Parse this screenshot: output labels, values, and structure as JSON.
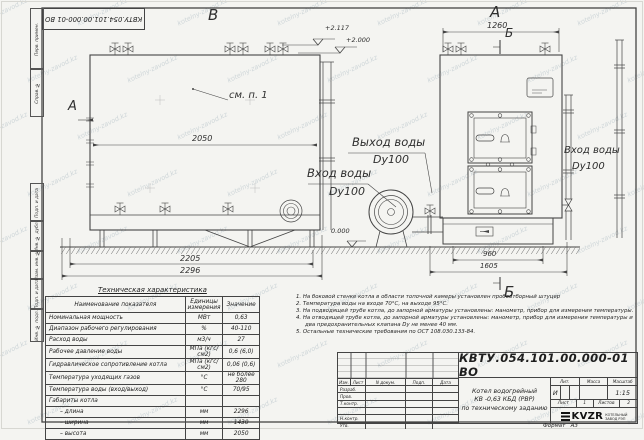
{
  "watermark": {
    "text": "kotelny-zavod.kz"
  },
  "border": {
    "top_left_designation": "КВТУ.054.101.00.000-01 ВО",
    "side_labels": [
      "Перв. примен.",
      "Справ. №",
      "Подп. и дата",
      "Инв. № дубл.",
      "Взам. инв. №",
      "Подп. и дата",
      "Инв. № подл."
    ]
  },
  "views": {
    "view_b_label": "В",
    "view_a_label": "А",
    "section_b_top": "Б",
    "section_b_bottom": "Б",
    "view_arrow_a": "А",
    "see_note": "см. п. 1",
    "elevations": {
      "top1": "+2.117",
      "top2": "+2.000",
      "zero": "0.000"
    },
    "labels": {
      "outlet": "Выход воды",
      "outlet_dn": "Dy100",
      "inlet_mid": "Вход воды",
      "inlet_mid_dn": "Dy100",
      "inlet_right": "Вход воды",
      "inlet_right_dn": "Dy100"
    },
    "dims": {
      "d2050": "2050",
      "d2205": "2205",
      "d2296": "2296",
      "d1260": "1260",
      "d960": "960",
      "d1605": "1605"
    }
  },
  "tech_table": {
    "title": "Техническая характеристика",
    "headers": [
      "Наименование показателя",
      "Единицы измерения",
      "Значение"
    ],
    "rows": [
      [
        "Номинальная мощность",
        "МВт",
        "0,63"
      ],
      [
        "Диапазон рабочего регулирования",
        "%",
        "40-110"
      ],
      [
        "Расход воды",
        "м3/ч",
        "27"
      ],
      [
        "Рабочее давление воды",
        "МПа (кгс/см2)",
        "0,6 (6,0)"
      ],
      [
        "Гидравлическое сопротивление котла",
        "МПа (кгс/см2)",
        "0,06 (0,6)"
      ],
      [
        "Температура уходящих газов",
        "°С",
        "не более 280"
      ],
      [
        "Температура воды (вход/выход)",
        "°С",
        "70/95"
      ],
      [
        "Габариты котла",
        "",
        ""
      ],
      [
        "– длина",
        "мм",
        "2296"
      ],
      [
        "– ширина",
        "мм",
        "1430"
      ],
      [
        "– высота",
        "мм",
        "2050"
      ]
    ]
  },
  "notes": [
    "1. На боковой стенке котла в области топочной камеры установлен пробоотборный штуцер",
    "2. Температура воды на входе 70°С, на выходе 95°С.",
    "3. На подводящей трубе котла, до запорной арматуры установлены: манометр, прибор для измерения температуры.",
    "4. На отводящей трубе котла, до запорной арматуры установлены: манометр, прибор для измерения температуры и два предохранительных клапана Dy не менее 40 мм.",
    "5. Остальные технические требования по ОСТ 108.030.133-84."
  ],
  "title_block": {
    "designation": "КВТУ.054.101.00.000-01 ВО",
    "rev_headers": {
      "izm": "Изм.",
      "list": "Лист",
      "doc": "N докум.",
      "sign": "Подп.",
      "date": "Дата"
    },
    "row_labels": [
      "Разраб.",
      "Пров.",
      "Т.контр.",
      "",
      "Н.контр.",
      "Утв."
    ],
    "product_lines": [
      "Котел водогрейный",
      "КВ -0,63 КБД (РВР)",
      "по техническому заданию"
    ],
    "lit_label": "Лит.",
    "mass_label": "Масса",
    "scale_label": "Масштаб",
    "lit_value": "И",
    "scale_value": "1:15",
    "sheet_label": "Лист",
    "sheet_value": "1",
    "sheets_label": "Листов",
    "sheets_value": "2",
    "logo_text": "KVZR",
    "logo_sub1": "КОТЕЛЬНЫЙ",
    "logo_sub2": "ЗАВОД РЭП",
    "format_label": "Формат",
    "format_value": "А3"
  }
}
